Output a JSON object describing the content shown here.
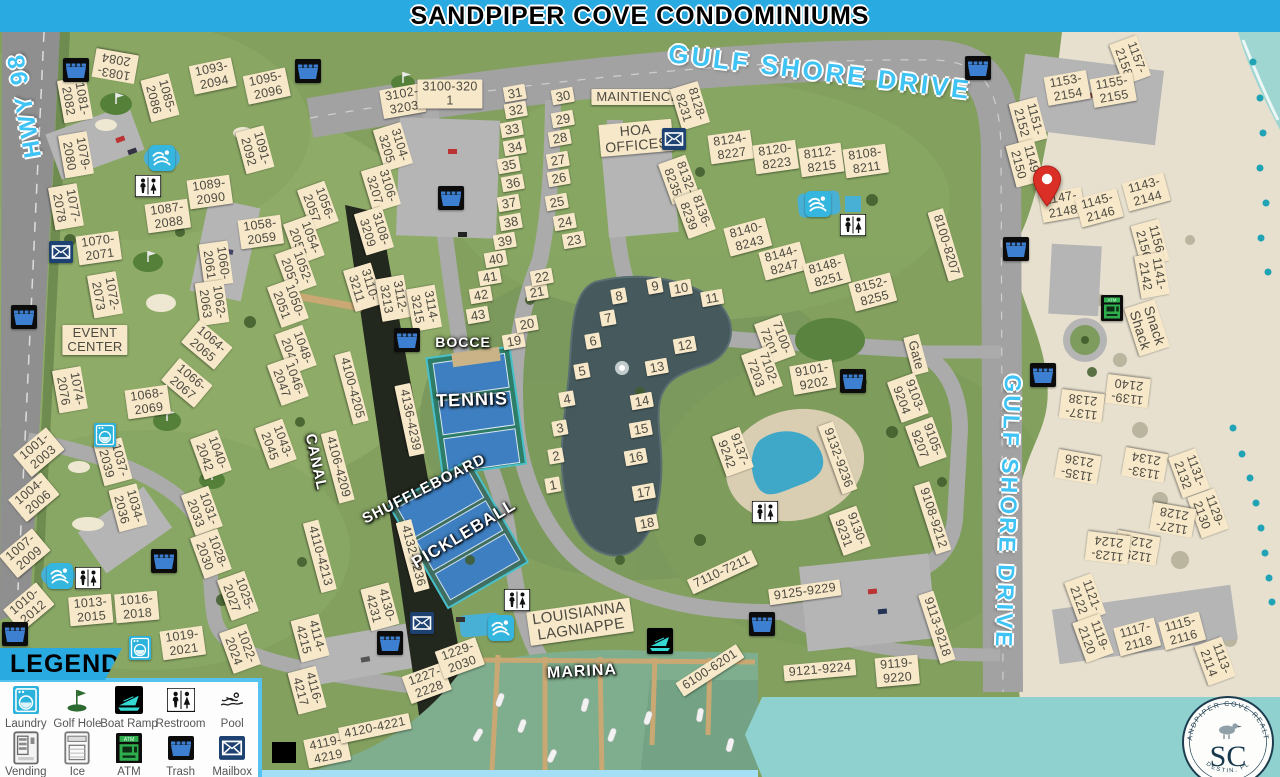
{
  "banner": {
    "title": "SANDPIPER COVE CONDOMINIUMS"
  },
  "map": {
    "road_labels": [
      {
        "t": "HWY 98",
        "x": 25,
        "y": 105,
        "r": -100,
        "s": 24
      },
      {
        "t": "GULF SHORE DRIVE",
        "x": 820,
        "y": 72,
        "r": 7,
        "s": 26
      },
      {
        "t": "GULF SHORE DRIVE",
        "x": 1008,
        "y": 512,
        "r": 92,
        "s": 23
      }
    ],
    "area_labels": [
      {
        "t": "BOCCE",
        "x": 463,
        "y": 342,
        "r": 0,
        "s": 14
      },
      {
        "t": "TENNIS",
        "x": 472,
        "y": 400,
        "r": -2,
        "s": 18
      },
      {
        "t": "SHUFFLEBOARD",
        "x": 424,
        "y": 489,
        "r": -27,
        "s": 15
      },
      {
        "t": "PICKLEBALL",
        "x": 464,
        "y": 534,
        "r": -31,
        "s": 17
      },
      {
        "t": "CANAL",
        "x": 316,
        "y": 462,
        "r": 78,
        "s": 15
      },
      {
        "t": "MARINA",
        "x": 582,
        "y": 672,
        "r": -3,
        "s": 16
      }
    ],
    "buildings": [
      [
        "1083-\n2084",
        115,
        66,
        190
      ],
      [
        "1085-\n2086",
        160,
        98,
        75
      ],
      [
        "1081-\n2082",
        75,
        100,
        80
      ],
      [
        "1079-\n2080",
        76,
        155,
        80
      ],
      [
        "1077-\n2078",
        66,
        207,
        80
      ],
      [
        "1093-\n2094",
        213,
        76,
        -12
      ],
      [
        "1095-\n2096",
        267,
        86,
        -12
      ],
      [
        "1091-\n2092",
        255,
        150,
        75
      ],
      [
        "1089-\n2090",
        210,
        192,
        -8
      ],
      [
        "1087-\n2088",
        168,
        216,
        -8
      ],
      [
        "1058-\n2059",
        261,
        232,
        -8
      ],
      [
        "1060-\n2061",
        216,
        264,
        82
      ],
      [
        "1062-\n2063",
        212,
        303,
        82
      ],
      [
        "1064-\n2065",
        207,
        345,
        40
      ],
      [
        "1066-\n2067",
        187,
        383,
        40
      ],
      [
        "1068-\n2069",
        148,
        402,
        -8
      ],
      [
        "1070-\n2071",
        99,
        248,
        -8
      ],
      [
        "1072-\n2073",
        105,
        295,
        80
      ],
      [
        "1074-\n2076",
        70,
        390,
        80
      ],
      [
        "EVENT\nCENTER",
        95,
        340,
        0,
        13
      ],
      [
        "1056-\n2057",
        318,
        206,
        70
      ],
      [
        "1054-\n2055",
        304,
        240,
        70
      ],
      [
        "1052-\n2053",
        296,
        270,
        70
      ],
      [
        "1050-\n2051",
        288,
        303,
        70
      ],
      [
        "1048-\n2049",
        296,
        350,
        70
      ],
      [
        "1046-\n2047",
        288,
        381,
        70
      ],
      [
        "1043-\n2045",
        276,
        444,
        70
      ],
      [
        "3102-\n3203",
        403,
        101,
        -10
      ],
      [
        "3100-320\n1",
        450,
        94,
        0
      ],
      [
        "3104-\n3205",
        393,
        147,
        73
      ],
      [
        "3106-\n3207",
        381,
        188,
        73
      ],
      [
        "3108-\n3209",
        374,
        231,
        73
      ],
      [
        "3110-\n3211",
        363,
        287,
        73
      ],
      [
        "3112-\n3213",
        393,
        298,
        80
      ],
      [
        "3114-\n3215",
        424,
        308,
        80
      ],
      [
        "4100-4205",
        352,
        388,
        75
      ],
      [
        "4136-4239",
        410,
        420,
        78
      ],
      [
        "4106-4209",
        338,
        467,
        75
      ],
      [
        "4110-4213",
        320,
        556,
        75
      ],
      [
        "4132-4236",
        413,
        556,
        75
      ],
      [
        "4130-\n4231",
        380,
        607,
        75
      ],
      [
        "4114-\n4215",
        310,
        638,
        75
      ],
      [
        "4116-\n4217",
        307,
        690,
        75
      ],
      [
        "4119-\n4219",
        327,
        750,
        -12
      ],
      [
        "4120-4221",
        375,
        728,
        -12
      ],
      [
        "1227-\n2228",
        427,
        683,
        -20
      ],
      [
        "1229-\n2030",
        460,
        658,
        -20
      ],
      [
        "LOUISIANNA\nLAGNIAPPE",
        580,
        622,
        -8,
        15
      ],
      [
        "1001-\n2003",
        39,
        452,
        -40
      ],
      [
        "1004-\n2006",
        34,
        497,
        -40
      ],
      [
        "1007-\n2009",
        25,
        553,
        -40
      ],
      [
        "1010-\n2012",
        29,
        607,
        -40
      ],
      [
        "1013-\n2015",
        91,
        610,
        -5
      ],
      [
        "1016-\n2018",
        137,
        607,
        -5
      ],
      [
        "1019-\n2021",
        183,
        643,
        -8
      ],
      [
        "1037-\n2039",
        113,
        462,
        75
      ],
      [
        "1034-\n2036",
        128,
        508,
        75
      ],
      [
        "1040-\n2042",
        211,
        455,
        70
      ],
      [
        "1031-\n2033",
        202,
        511,
        70
      ],
      [
        "1028-\n2030",
        211,
        554,
        70
      ],
      [
        "1025-\n2027",
        238,
        596,
        70
      ],
      [
        "1022-\n2024",
        240,
        649,
        70
      ],
      [
        "MAINTIENCE",
        638,
        97,
        0,
        13
      ],
      [
        "HOA\nOFFICES",
        636,
        138,
        -5,
        14
      ],
      [
        "8128-\n8231",
        690,
        106,
        73
      ],
      [
        "8124-\n8227",
        731,
        147,
        -8
      ],
      [
        "8120-\n8223",
        776,
        157,
        -8
      ],
      [
        "8112-\n8215",
        821,
        160,
        -8
      ],
      [
        "8108-\n8211",
        866,
        161,
        -8
      ],
      [
        "8132-\n8235",
        679,
        180,
        70
      ],
      [
        "8136-\n8239",
        695,
        214,
        70
      ],
      [
        "8140-\n8243",
        748,
        237,
        -15
      ],
      [
        "8144-\n8247",
        783,
        261,
        -15
      ],
      [
        "8148-\n8251",
        827,
        273,
        -15
      ],
      [
        "8152-\n8255",
        873,
        292,
        -15
      ],
      [
        "8100-8207",
        946,
        245,
        73
      ],
      [
        "7100-\n7201",
        775,
        340,
        70
      ],
      [
        "7102-\n7203",
        762,
        371,
        70
      ],
      [
        "9101-\n9202",
        813,
        377,
        -10
      ],
      [
        "Gate",
        916,
        355,
        75,
        13
      ],
      [
        "9103-\n9204",
        908,
        398,
        70
      ],
      [
        "9105-\n9207",
        926,
        442,
        70
      ],
      [
        "9108-9212",
        933,
        518,
        72
      ],
      [
        "9113-9218",
        937,
        627,
        72
      ],
      [
        "9119-\n9220",
        897,
        671,
        -5
      ],
      [
        "9121-9224",
        820,
        670,
        -5
      ],
      [
        "9125-9229",
        805,
        592,
        -8
      ],
      [
        "9130-\n9231",
        850,
        531,
        70
      ],
      [
        "9132-9236",
        838,
        458,
        70
      ],
      [
        "9137-\n9242",
        733,
        452,
        70
      ],
      [
        "7110-7211",
        722,
        572,
        -25
      ],
      [
        "6100-6201",
        710,
        670,
        -33
      ],
      [
        "1157-\n2158",
        1130,
        60,
        70
      ],
      [
        "1153-\n2154",
        1067,
        88,
        -10
      ],
      [
        "1155-\n2155",
        1113,
        90,
        -10
      ],
      [
        "1151-\n2152",
        1028,
        121,
        75
      ],
      [
        "1149-\n2150",
        1025,
        163,
        75
      ],
      [
        "1147-\n2148",
        1062,
        205,
        -10
      ],
      [
        "1145-\n2146",
        1099,
        208,
        -15
      ],
      [
        "1143-\n2144",
        1146,
        192,
        -15
      ],
      [
        "1156-\n2156",
        1150,
        243,
        75
      ],
      [
        "1141-\n2142",
        1152,
        275,
        80
      ],
      [
        "Snack\nShack",
        1147,
        328,
        72,
        14
      ],
      [
        "1139-\n2140",
        1128,
        391,
        187
      ],
      [
        "1137-\n2138",
        1082,
        406,
        187
      ],
      [
        "1135-\n2136",
        1078,
        467,
        190
      ],
      [
        "1133-\n2134",
        1145,
        465,
        190
      ],
      [
        "1131-\n2132",
        1189,
        473,
        70
      ],
      [
        "1129-\n2130",
        1208,
        513,
        70
      ],
      [
        "1127-\n2128",
        1173,
        520,
        190
      ],
      [
        "1125-\n2126",
        1137,
        548,
        190
      ],
      [
        "1123-\n2124",
        1108,
        548,
        187
      ],
      [
        "1121-\n2122",
        1085,
        598,
        70
      ],
      [
        "1119-\n2120",
        1093,
        638,
        70
      ],
      [
        "1117-\n2118",
        1137,
        637,
        -15
      ],
      [
        "1115-\n2116",
        1182,
        631,
        -15
      ],
      [
        "1113-\n2114",
        1215,
        661,
        70
      ]
    ],
    "units": [
      [
        "1",
        553,
        485
      ],
      [
        "2",
        556,
        456
      ],
      [
        "3",
        560,
        428
      ],
      [
        "4",
        567,
        399
      ],
      [
        "5",
        582,
        371
      ],
      [
        "6",
        593,
        341
      ],
      [
        "7",
        608,
        318
      ],
      [
        "8",
        619,
        296
      ],
      [
        "9",
        655,
        286
      ],
      [
        "10",
        681,
        288
      ],
      [
        "11",
        712,
        298
      ],
      [
        "12",
        685,
        345
      ],
      [
        "13",
        657,
        367
      ],
      [
        "14",
        642,
        401
      ],
      [
        "15",
        641,
        429
      ],
      [
        "16",
        636,
        457
      ],
      [
        "17",
        644,
        492
      ],
      [
        "18",
        647,
        523
      ],
      [
        "19",
        514,
        341
      ],
      [
        "20",
        527,
        324
      ],
      [
        "21",
        537,
        292
      ],
      [
        "22",
        542,
        277
      ],
      [
        "23",
        574,
        240
      ],
      [
        "24",
        565,
        222
      ],
      [
        "25",
        557,
        202
      ],
      [
        "26",
        559,
        178
      ],
      [
        "27",
        558,
        160
      ],
      [
        "28",
        560,
        138
      ],
      [
        "29",
        563,
        119
      ],
      [
        "30",
        563,
        96
      ],
      [
        "31",
        515,
        93
      ],
      [
        "32",
        516,
        110
      ],
      [
        "33",
        512,
        129
      ],
      [
        "34",
        515,
        147
      ],
      [
        "35",
        509,
        165
      ],
      [
        "36",
        513,
        183
      ],
      [
        "37",
        509,
        203
      ],
      [
        "38",
        511,
        222
      ],
      [
        "39",
        505,
        241
      ],
      [
        "40",
        496,
        259
      ],
      [
        "41",
        490,
        277
      ],
      [
        "42",
        481,
        295
      ],
      [
        "43",
        478,
        315
      ]
    ],
    "icons": [
      [
        "trash",
        76,
        70
      ],
      [
        "trash",
        308,
        71
      ],
      [
        "trash",
        978,
        68
      ],
      [
        "trash",
        24,
        317
      ],
      [
        "trash",
        451,
        198
      ],
      [
        "trash",
        407,
        340
      ],
      [
        "trash",
        164,
        561
      ],
      [
        "trash",
        15,
        634
      ],
      [
        "trash",
        390,
        643
      ],
      [
        "trash",
        762,
        624
      ],
      [
        "trash",
        853,
        381
      ],
      [
        "trash",
        1016,
        249
      ],
      [
        "trash",
        1043,
        375
      ],
      [
        "mailbox",
        61,
        252
      ],
      [
        "mailbox",
        674,
        139
      ],
      [
        "mailbox",
        422,
        623
      ],
      [
        "laundry",
        105,
        435
      ],
      [
        "laundry",
        140,
        648
      ],
      [
        "atm",
        1112,
        308
      ],
      [
        "restroom",
        148,
        186
      ],
      [
        "restroom",
        88,
        578
      ],
      [
        "restroom",
        853,
        225
      ],
      [
        "restroom",
        765,
        512
      ],
      [
        "restroom",
        517,
        600
      ],
      [
        "pool",
        162,
        158
      ],
      [
        "pool",
        60,
        576
      ],
      [
        "pool",
        818,
        204
      ],
      [
        "pool",
        501,
        628
      ],
      [
        "boatramp",
        660,
        641
      ]
    ],
    "pin": {
      "x": 1047,
      "y": 207
    }
  },
  "legend": {
    "title": "LEGEND",
    "items": [
      {
        "icon": "laundry",
        "label": "Laundry"
      },
      {
        "icon": "golf",
        "label": "Golf Hole"
      },
      {
        "icon": "boatramp",
        "label": "Boat Ramp"
      },
      {
        "icon": "restroom",
        "label": "Restroom"
      },
      {
        "icon": "poolswim",
        "label": "Pool"
      },
      {
        "icon": "vending",
        "label": "Vending"
      },
      {
        "icon": "ice",
        "label": "Ice"
      },
      {
        "icon": "atm",
        "label": "ATM"
      },
      {
        "icon": "trash",
        "label": "Trash"
      },
      {
        "icon": "mailbox",
        "label": "Mailbox"
      }
    ]
  },
  "logo": {
    "arc_top": "SANDPIPER COVE REALTY",
    "initials": "SC",
    "arc_bottom": "DESTIN, FL"
  },
  "colors": {
    "banner": "#29abe2",
    "road_text": "#3fc3f4",
    "label_bg": "#f6e8c8",
    "teal_band": "#8ed1ce",
    "atm_green": "#2fae4e",
    "pin_red": "#da2f27"
  }
}
